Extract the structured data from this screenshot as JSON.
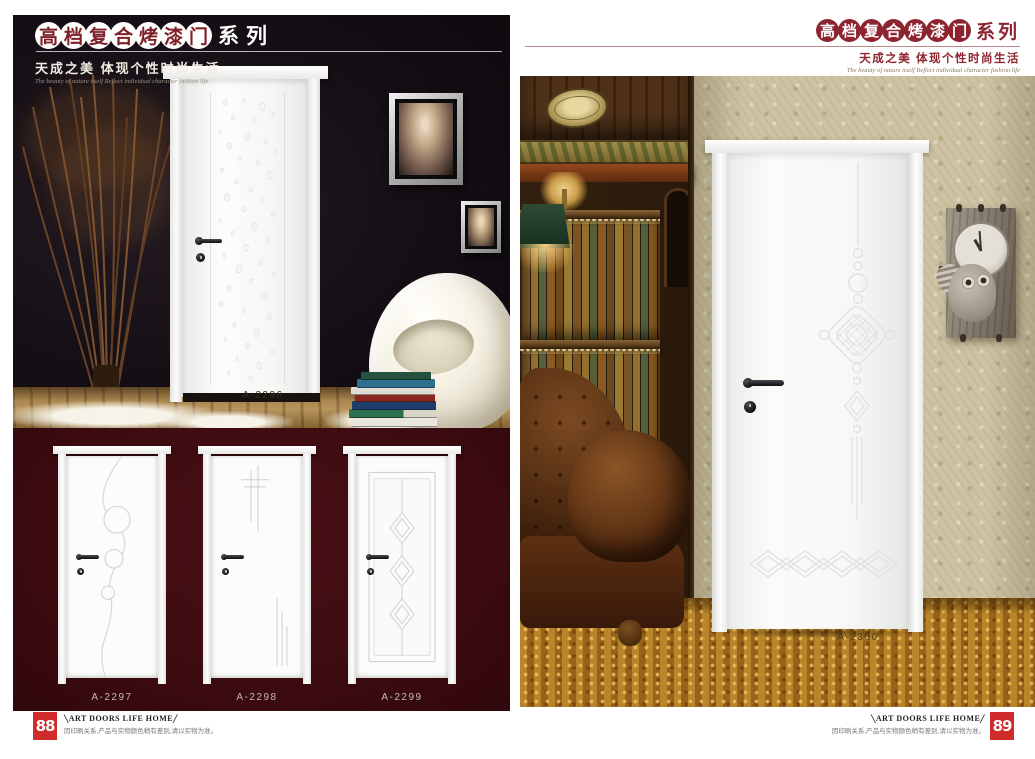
{
  "colors": {
    "maroon": "#8e2430",
    "burgundy_panel": "#400d13",
    "page_number_red": "#d02c2c",
    "carpet_gold": "#a4731f",
    "wallpaper_beige": "#cdc3a2"
  },
  "left_page": {
    "header": {
      "title_chars": [
        "高",
        "档",
        "复",
        "合",
        "烤",
        "漆",
        "门"
      ],
      "title_suffix": "系列",
      "tagline": "天成之美 体现个性时尚生活",
      "tagline_en": "The beauty of nature itself Reflect individual character fashion life"
    },
    "scene": {
      "door_label": "A-2296"
    },
    "showcase": {
      "doors": [
        {
          "label": "A-2297"
        },
        {
          "label": "A-2298"
        },
        {
          "label": "A-2299"
        }
      ]
    },
    "footer": {
      "page_number": "88",
      "brand_left_mark": "╲",
      "brand": "ART DOORS LIFE HOME",
      "brand_right_mark": "╱",
      "note": "因印刷关系,产品与实物颜色稍有差别,请以实物为准。"
    }
  },
  "right_page": {
    "header": {
      "title_chars": [
        "高",
        "档",
        "复",
        "合",
        "烤",
        "漆",
        "门"
      ],
      "title_suffix": "系列",
      "tagline": "天成之美 体现个性时尚生活",
      "tagline_en": "The beauty of nature itself Reflect individual character fashion life"
    },
    "scene": {
      "door_label": "A-2300"
    },
    "footer": {
      "page_number": "89",
      "brand_left_mark": "╲",
      "brand": "ART DOORS LIFE HOME",
      "brand_right_mark": "╱",
      "note": "因印刷关系,产品与实物颜色稍有差别,请以实物为准。"
    }
  }
}
